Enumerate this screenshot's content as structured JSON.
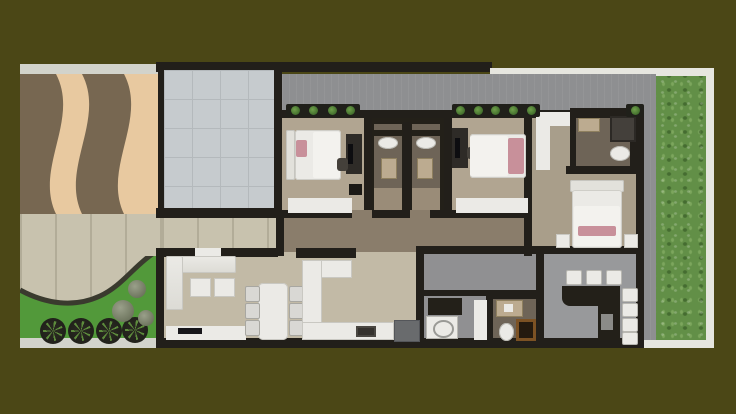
{
  "scene": {
    "type": "floor-plan-render",
    "view": "top-down",
    "description": "3D rendered top-down floor plan of a single-storey house on a plot with driveway, front garden and side lawn",
    "background_color": "#4b4716"
  },
  "palette": {
    "olive": "#4b4716",
    "border-white": "#e6e6df",
    "sidewalk": "#d2d3cb",
    "driveway-tan": "#e8c9a0",
    "driveway-brown": "#776751",
    "paver": "#c8c2ae",
    "paver-seam": "#b2ac98",
    "garage-tile": "#c6cbce",
    "tile-seam": "#b4b9bc",
    "walkway": "#8e8f91",
    "grass": "#628f47",
    "garden": "#52993a",
    "garden-border": "#3a3a2e",
    "wall": "#221f1a",
    "living-floor": "#c2baa6",
    "bedroom-floor": "#b1a591",
    "hall-floor": "#8a7d6b",
    "bath-floor": "#6e6457",
    "bath-floor-light": "#9a8c78",
    "service-floor": "#909092",
    "patio-floor": "#98999b",
    "master-floor": "#a99e8a",
    "closet-floor": "#a89e8b",
    "furniture-white": "#ebeae6",
    "duvet-white": "#f3f2ee",
    "pillow-pink": "#c8909a",
    "counter-dark": "#232019",
    "desk-dark": "#2e2b27",
    "appliance-gray": "#696b6d",
    "steel-gray": "#8b8b88",
    "wood-brown": "#7c5224",
    "wood-dark": "#241a0f",
    "fixture-tan": "#bcab90",
    "plant-green": "#4e7d35",
    "palm-pit": "#20201a",
    "bush-sage": "#9aa08a",
    "shower-dark": "#44403b",
    "chair-gray": "#d9d8d4"
  },
  "outdoor_areas": [
    "wavy driveway",
    "front paver patio",
    "curved garden bed",
    "garage",
    "north walkway",
    "east lawn",
    "entry porch"
  ],
  "rooms": [
    "living-room",
    "dining-area",
    "kitchen",
    "hallway",
    "bedroom-1",
    "bathroom-1",
    "bathroom-2",
    "bedroom-2",
    "walk-in-closet",
    "master-bathroom",
    "master-bedroom",
    "laundry-room",
    "powder-bathroom",
    "back-patio-bar"
  ],
  "furniture_counts": {
    "palm_trees": 4,
    "garden_bushes": 3,
    "beds": 3,
    "desks_with_pc": 2,
    "wardrobes": 3,
    "dining_chairs": 6,
    "sofa_ottomans": 2,
    "bar_stools": 7,
    "toilets": 4,
    "sinks": 4,
    "planter_boxes": 3
  }
}
